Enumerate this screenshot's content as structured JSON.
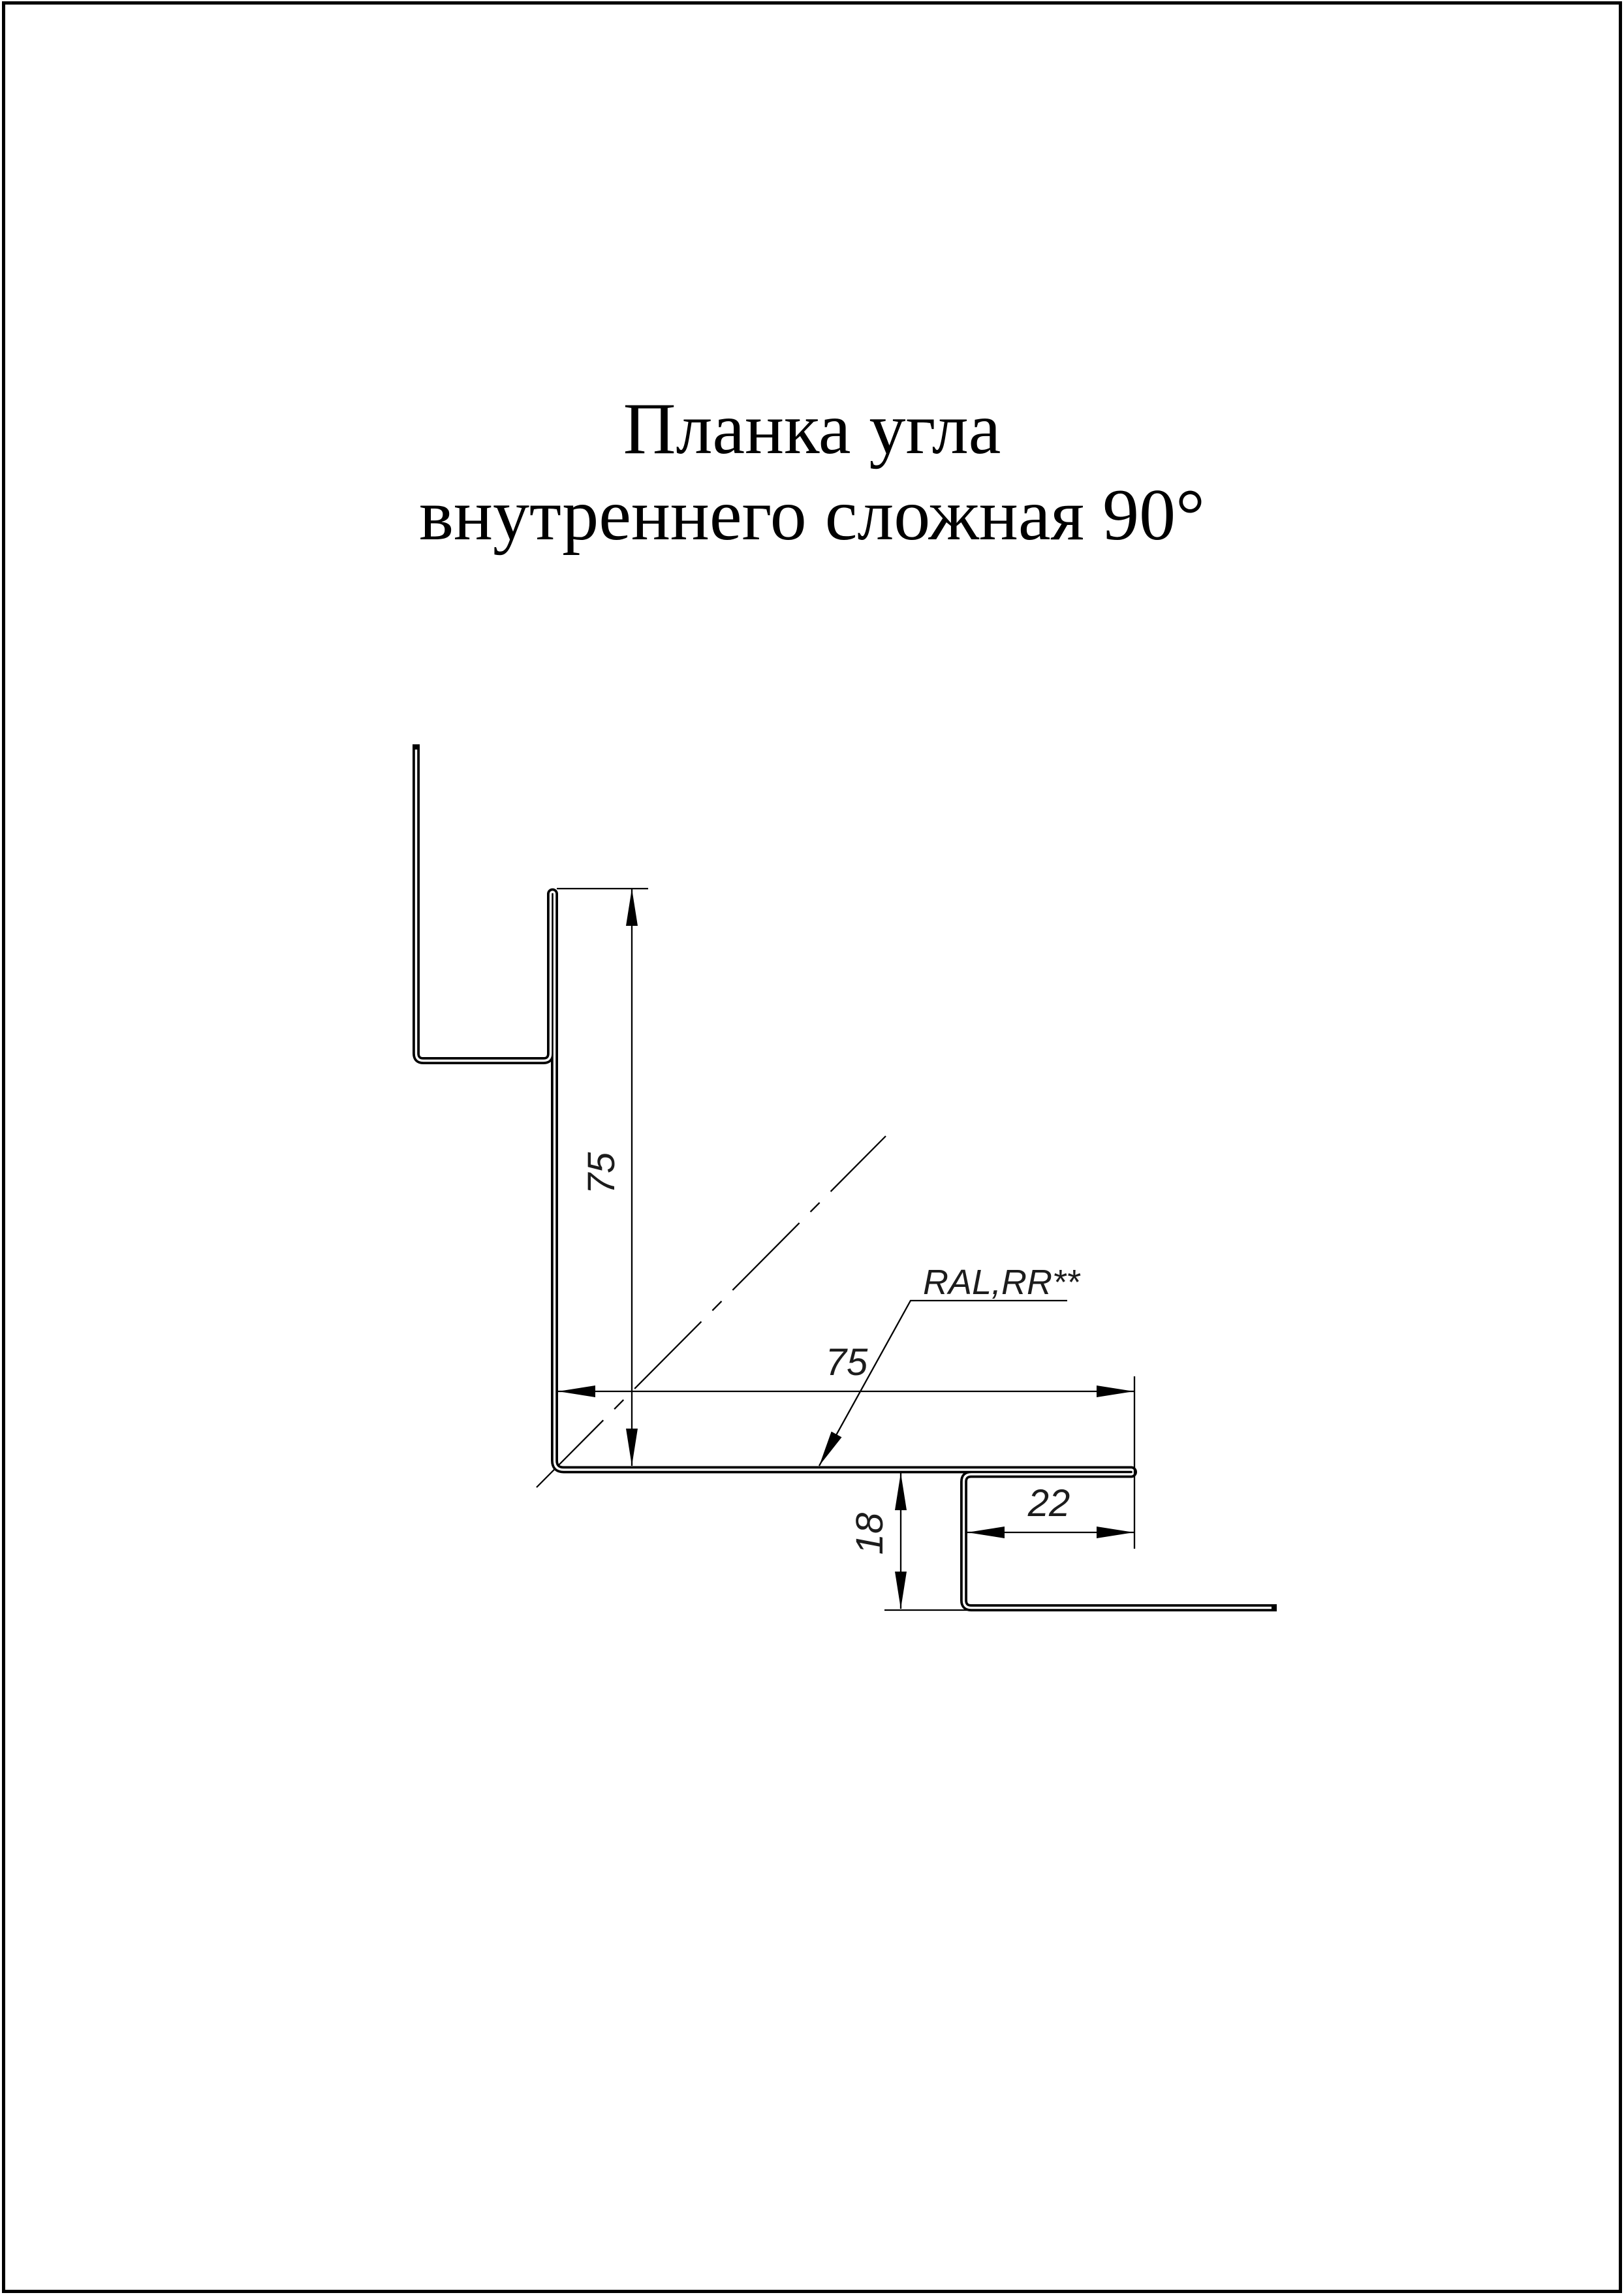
{
  "page": {
    "background": "#ffffff",
    "border_color": "#000000",
    "title": {
      "line1": "Планка угла",
      "line2": "внутреннего сложная 90°"
    }
  },
  "drawing": {
    "line_color": "#000000",
    "dim_text_color": "#1c1c1c",
    "dimensions": {
      "vertical_leg": "75",
      "horizontal_leg": "75",
      "hook_width": "22",
      "hook_depth": "18"
    },
    "coating_label": "RAL,RR**"
  }
}
